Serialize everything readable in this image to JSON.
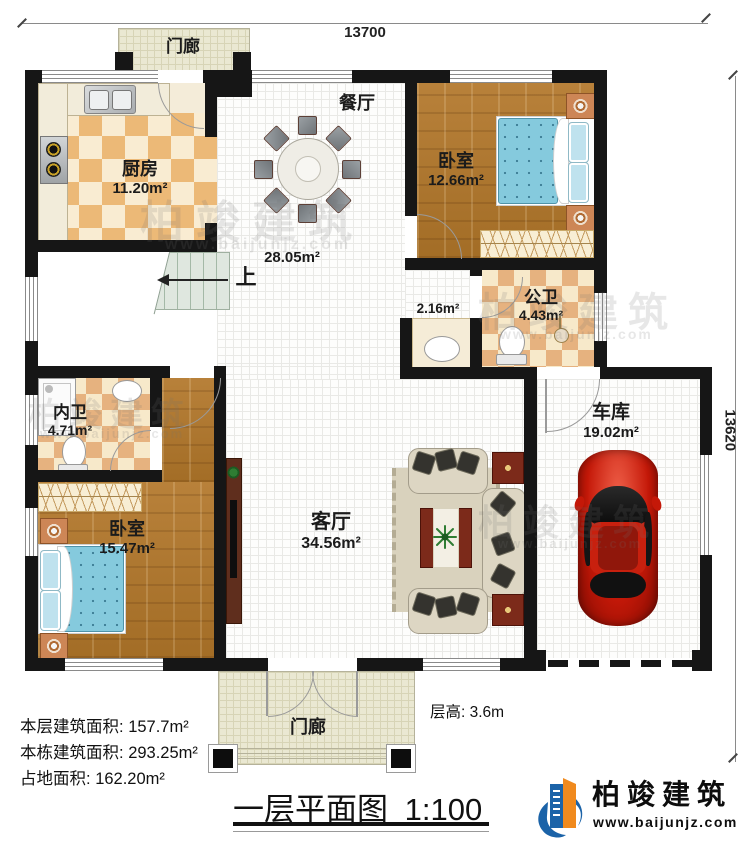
{
  "dimensions": {
    "width_label": "13700",
    "height_label": "13620"
  },
  "rooms": {
    "porch_top": {
      "name": "门廊"
    },
    "kitchen": {
      "name": "厨房",
      "area": "11.20m²"
    },
    "dining": {
      "name": "餐厅"
    },
    "hall": {
      "area": "28.05m²"
    },
    "stairs": {
      "direction": "上"
    },
    "bedroom_top": {
      "name": "卧室",
      "area": "12.66m²"
    },
    "corridor": {
      "area": "2.16m²"
    },
    "public_bath": {
      "name": "公卫",
      "area": "4.43m²"
    },
    "master_bath": {
      "name": "内卫",
      "area": "4.71m²"
    },
    "bedroom_left": {
      "name": "卧室",
      "area": "15.47m²"
    },
    "living": {
      "name": "客厅",
      "area": "34.56m²"
    },
    "garage": {
      "name": "车库",
      "area": "19.02m²"
    },
    "porch_bottom": {
      "name": "门廊"
    }
  },
  "annotations": {
    "floor_height_label": "层高:",
    "floor_height_value": "3.6m",
    "stats": [
      {
        "label": "本层建筑面积:",
        "value": "157.7m²"
      },
      {
        "label": "本栋建筑面积:",
        "value": "293.25m²"
      },
      {
        "label": "占地面积:",
        "value": "162.20m²"
      }
    ]
  },
  "title": {
    "text": "一层平面图",
    "scale": "1:100"
  },
  "brand": {
    "name": "柏竣建筑",
    "url": "www.baijunjz.com"
  },
  "watermark": {
    "text": "柏竣建筑",
    "url": "www.baijunjz.com"
  },
  "colors": {
    "wall": "#161616",
    "wood": "#b0792f",
    "tile": "#ecb977",
    "accent_blue": "#1b63a8",
    "accent_orange": "#f08a1e",
    "bed_blue": "#85cadd",
    "car_red": "#c41808"
  }
}
